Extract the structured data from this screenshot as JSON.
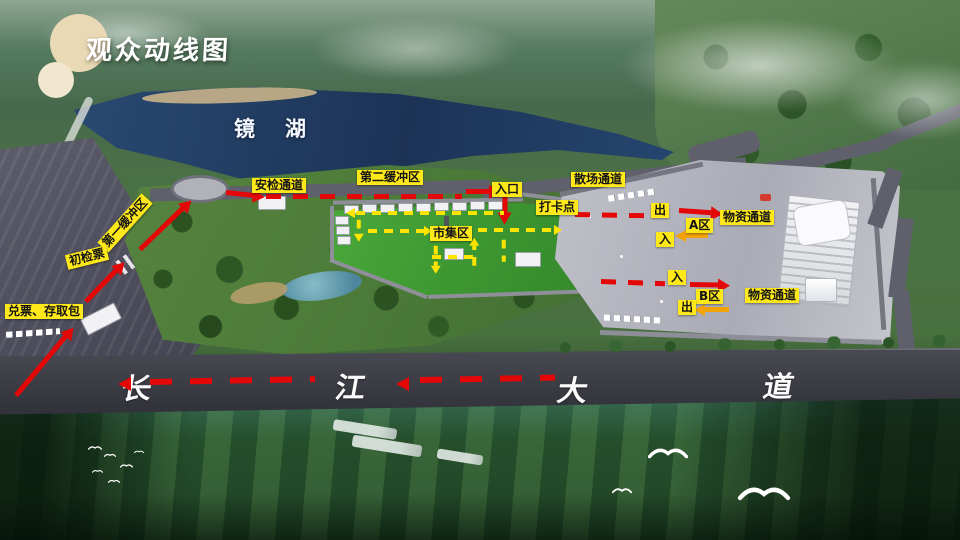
{
  "title": "观众动线图",
  "lake": {
    "name": "镜湖"
  },
  "road": {
    "chars": [
      "长",
      "江",
      "大",
      "道"
    ]
  },
  "labels": {
    "security_channel": "安检通道",
    "buffer_zone_2": "第二缓冲区",
    "entrance": "入口",
    "dispersal_channel": "散场通道",
    "checkin_point": "打卡点",
    "market_zone": "市集区",
    "buffer_zone_1": "第一缓冲区",
    "initial_ticket_check": "初检票",
    "ticket_exchange_bag_storage": "兑票、存取包",
    "zone_a": "A区",
    "zone_a_out": "出",
    "zone_a_in": "入",
    "zone_a_supply_channel": "物资通道",
    "zone_b": "B区",
    "zone_b_in": "入",
    "zone_b_out": "出",
    "zone_b_supply_channel": "物资通道"
  },
  "colors": {
    "label_bg": "#ffe81a",
    "visitor_route_red": "#e30707",
    "market_route_yellow": "#ffe400",
    "supply_route_orange": "#f2a30a",
    "road_text_white": "#fbfbfb",
    "lake_blue": "#1c3356",
    "plaza_gray": "#b4b5bf",
    "market_green": "#3b9430"
  }
}
